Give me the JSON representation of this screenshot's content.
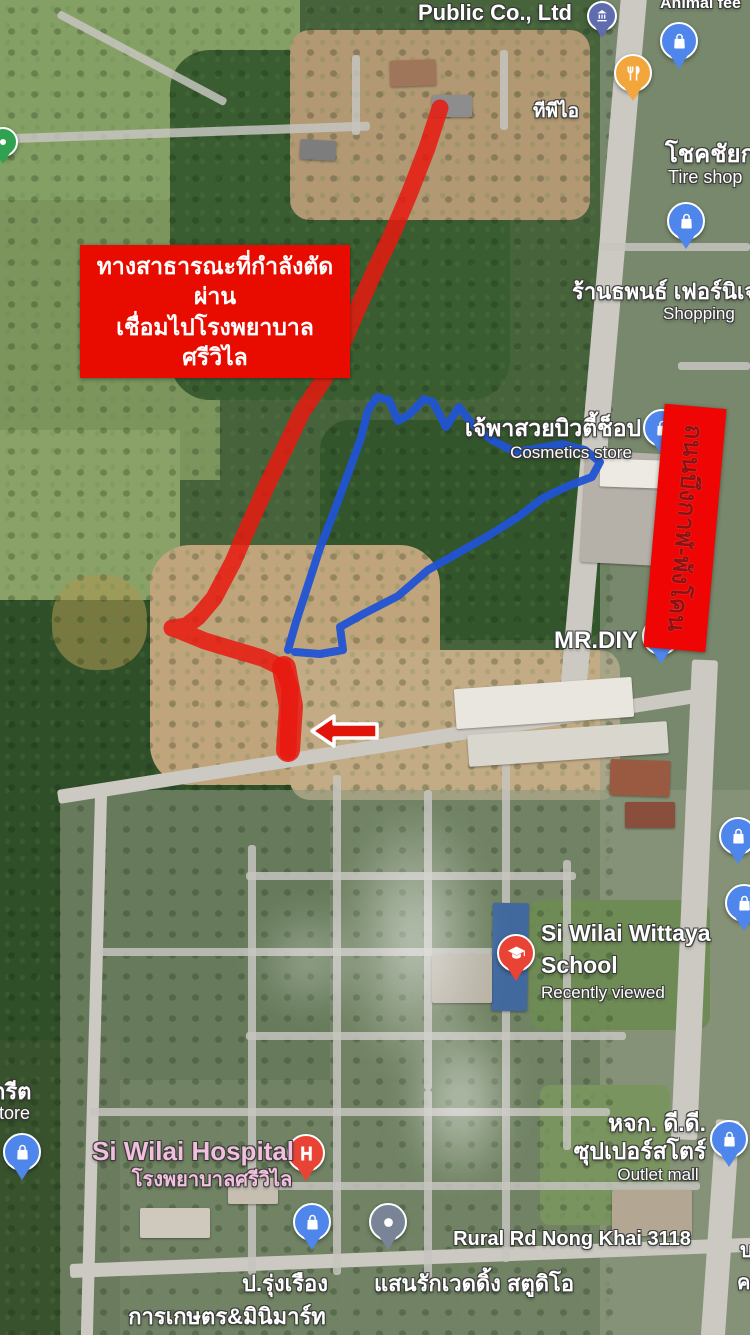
{
  "labels": {
    "public_co": {
      "title": "Public Co., Ltd",
      "thai": "ทีพีไอ"
    },
    "animal_feed": {
      "title": "Animal fee"
    },
    "tire": {
      "thai": "โชคชัยก",
      "en": "Tire shop"
    },
    "furniture": {
      "thai": "ร้านธพนธ์ เฟอร์นิเจ",
      "en": "Shopping"
    },
    "cosmetics": {
      "thai": "เจ้พาสวยบิวตี้ช็อป",
      "en": "Cosmetics store"
    },
    "mrdiy": {
      "title": "MR.DIY"
    },
    "school": {
      "line1": "Si Wilai Wittaya",
      "line2": "School",
      "status": "Recently viewed"
    },
    "hospital": {
      "en": "Si Wilai Hospital",
      "thai": "โรงพยาบาลศรีวิไล"
    },
    "store_left": {
      "thai": "กรีต",
      "en": "store"
    },
    "outlet": {
      "thai1": "หจก. ดี.ดี.",
      "thai2": "ซุปเปอร์สโตร์",
      "en": "Outlet mall"
    },
    "rural_road": {
      "title": "Rural Rd Nong Khai 3118"
    },
    "wedding": {
      "thai": "แสนรักเวดดิ้ง สตูดิโอ"
    },
    "agri": {
      "thai1": "ป.รุ่งเรือง",
      "thai2": "การเกษตร&มินิมาร์ท"
    },
    "edge_fragments": {
      "f1": "บ",
      "f2": "ค"
    }
  },
  "annotations": {
    "banner": {
      "line1": "ทางสาธารณะที่กำลังตัดผ่าน",
      "line2": "เชื่อมไปโรงพยาบาลศรีวิไล"
    },
    "road_banner": {
      "text": "ถนนบึงกาฬ-พังโคน"
    }
  },
  "icons": {
    "shopping-bag-marker": "white shopping bag on blue pin",
    "restaurant-marker": "white fork and knife on amber pin",
    "school-marker": "white graduation cap on red pin",
    "hospital-marker": "white letter H on red pin",
    "place-dot-marker": "white dot on slate pin",
    "monument-marker": "white building on indigo pin",
    "generic-green-marker": "green pin (clipped at edge)",
    "red-arrow": "red arrow with white outline",
    "red-route": "red highlighted new road",
    "blue-boundary": "blue land parcel boundary line"
  },
  "colors": {
    "annotation_red": "#e8150d",
    "path_blue": "#2153d4",
    "banner_red": "#e80c00",
    "road_banner_text": "#8e1212",
    "marker_blue": "#4f86ec",
    "marker_amber": "#f2a63b",
    "marker_red": "#e94335",
    "marker_slate": "#7a8497",
    "hospital_label_pink": "#f2c0de"
  }
}
